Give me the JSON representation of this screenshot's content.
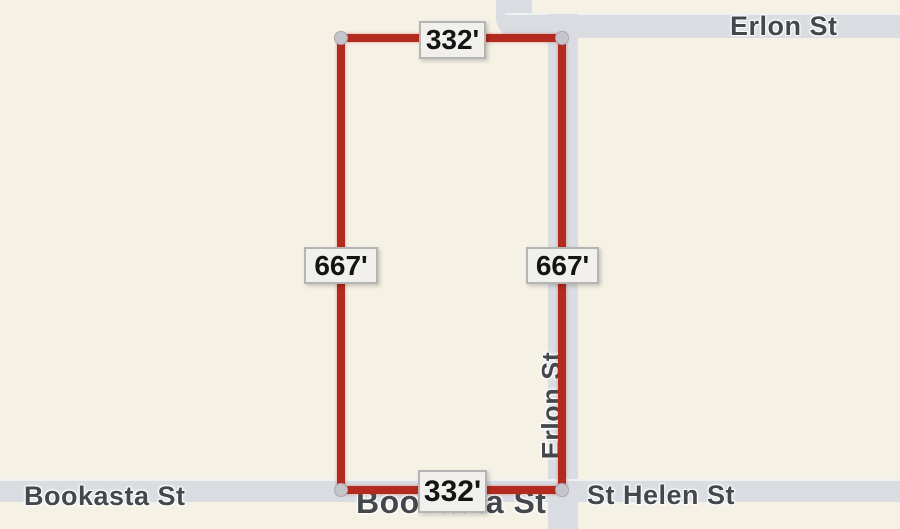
{
  "map": {
    "type": "street-map",
    "background_color": "#f6f1e5",
    "road_color": "#d9dde2",
    "streets": {
      "erlon_top_label": "Erlon St",
      "erlon_vertical_label": "Erlon St",
      "bookasta_label": "Bookasta St",
      "bookasta_center_label": "Bookasta St",
      "st_helen_label": "St Helen St"
    }
  },
  "parcel": {
    "outline_color": "#b32a1e",
    "vertex_color": "#c5c5cb",
    "dimensions": {
      "top": "332'",
      "bottom": "332'",
      "left": "667'",
      "right": "667'"
    }
  }
}
